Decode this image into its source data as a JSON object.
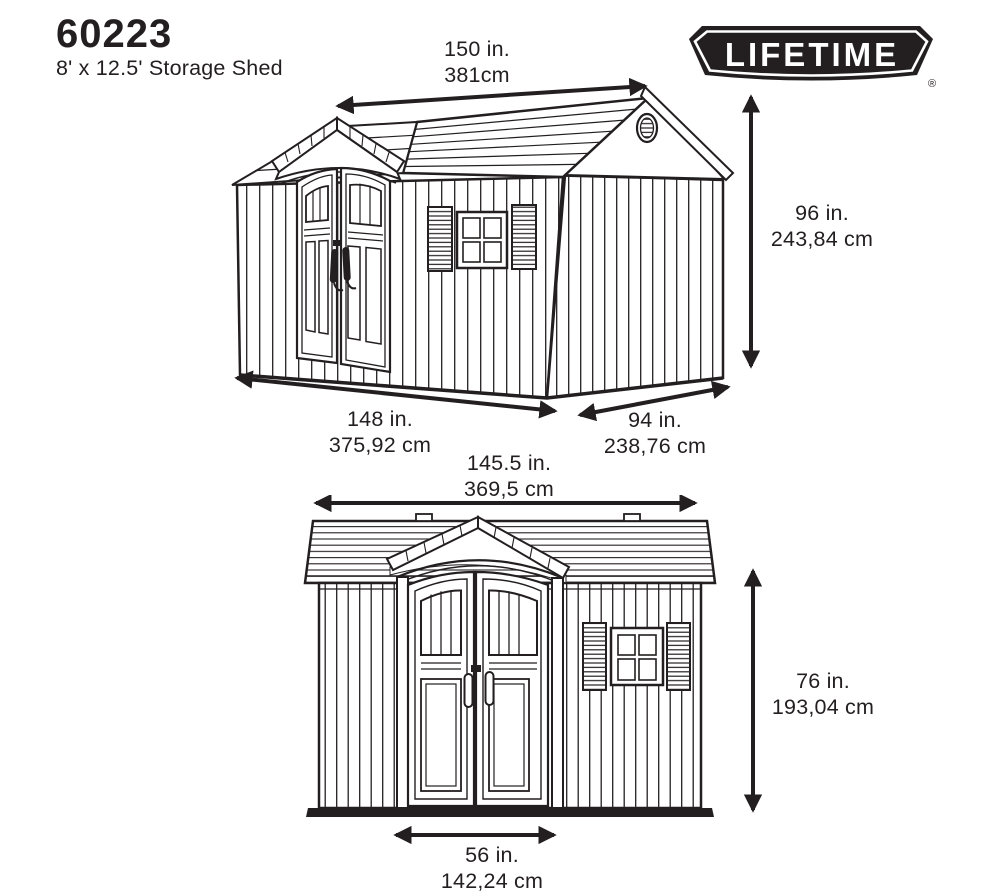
{
  "colors": {
    "ink": "#231f20",
    "background": "#ffffff"
  },
  "header": {
    "model": "60223",
    "product": "8' x 12.5' Storage Shed"
  },
  "logo": {
    "brand": "LIFETIME",
    "registered_mark": "®"
  },
  "views": {
    "perspective": {
      "roof_length_in": "150 in.",
      "roof_length_cm": "381cm",
      "height_in": "96 in.",
      "height_cm": "243,84 cm",
      "side_length_in": "148 in.",
      "side_length_cm": "375,92 cm",
      "end_width_in": "94 in.",
      "end_width_cm": "238,76 cm"
    },
    "front": {
      "width_in": "145.5 in.",
      "width_cm": "369,5 cm",
      "height_in": "76 in.",
      "height_cm": "193,04 cm",
      "door_width_in": "56 in.",
      "door_width_cm": "142,24 cm"
    }
  }
}
